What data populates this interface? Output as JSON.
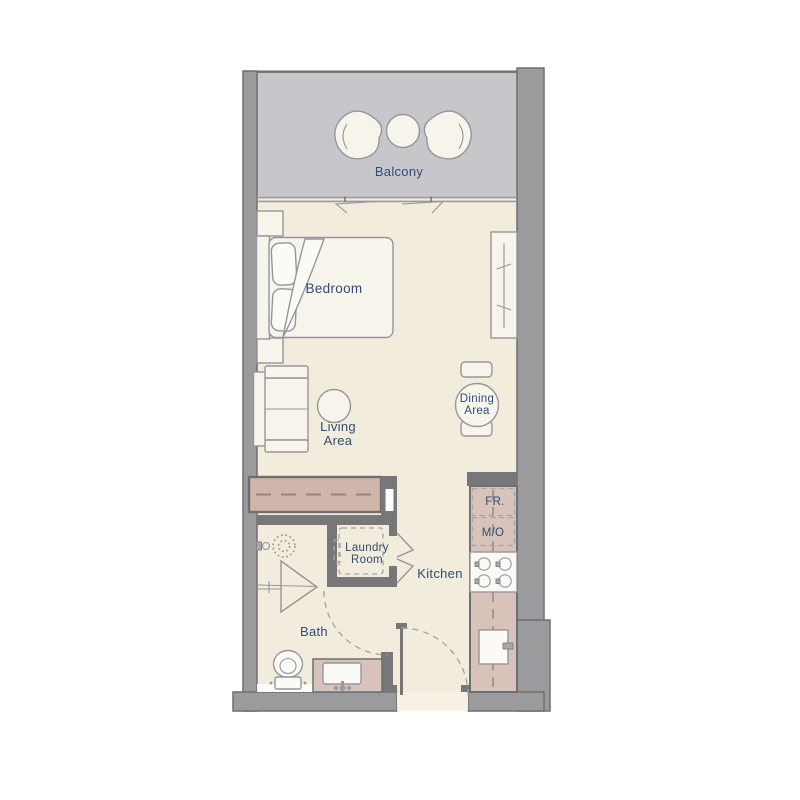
{
  "colors": {
    "wall": "#9b9b9d",
    "wall_stroke": "#6f6f72",
    "iwall": "#77777a",
    "balcony_floor": "#c7c7cb",
    "floor": "#f2ecdc",
    "accent_closet": "#cfb5aa",
    "accent_counter": "#d7c3b9",
    "furniture": "#f7f4ec",
    "furniture_stroke": "#96969a",
    "dash": "#a5a5a8",
    "dash_accent": "#9b8378",
    "label_text": "#2e4e74"
  },
  "rooms": {
    "balcony": {
      "label": "Balcony"
    },
    "bedroom": {
      "label": "Bedroom"
    },
    "living_area": {
      "label_line1": "Living",
      "label_line2": "Area"
    },
    "dining_area": {
      "label_line1": "Dining",
      "label_line2": "Area"
    },
    "kitchen": {
      "label": "Kitchen"
    },
    "laundry_room": {
      "label_line1": "Laundry",
      "label_line2": "Room"
    },
    "bath": {
      "label": "Bath"
    }
  },
  "appliances": {
    "fridge_label": "FR.",
    "microwave_oven_label": "M/O"
  }
}
